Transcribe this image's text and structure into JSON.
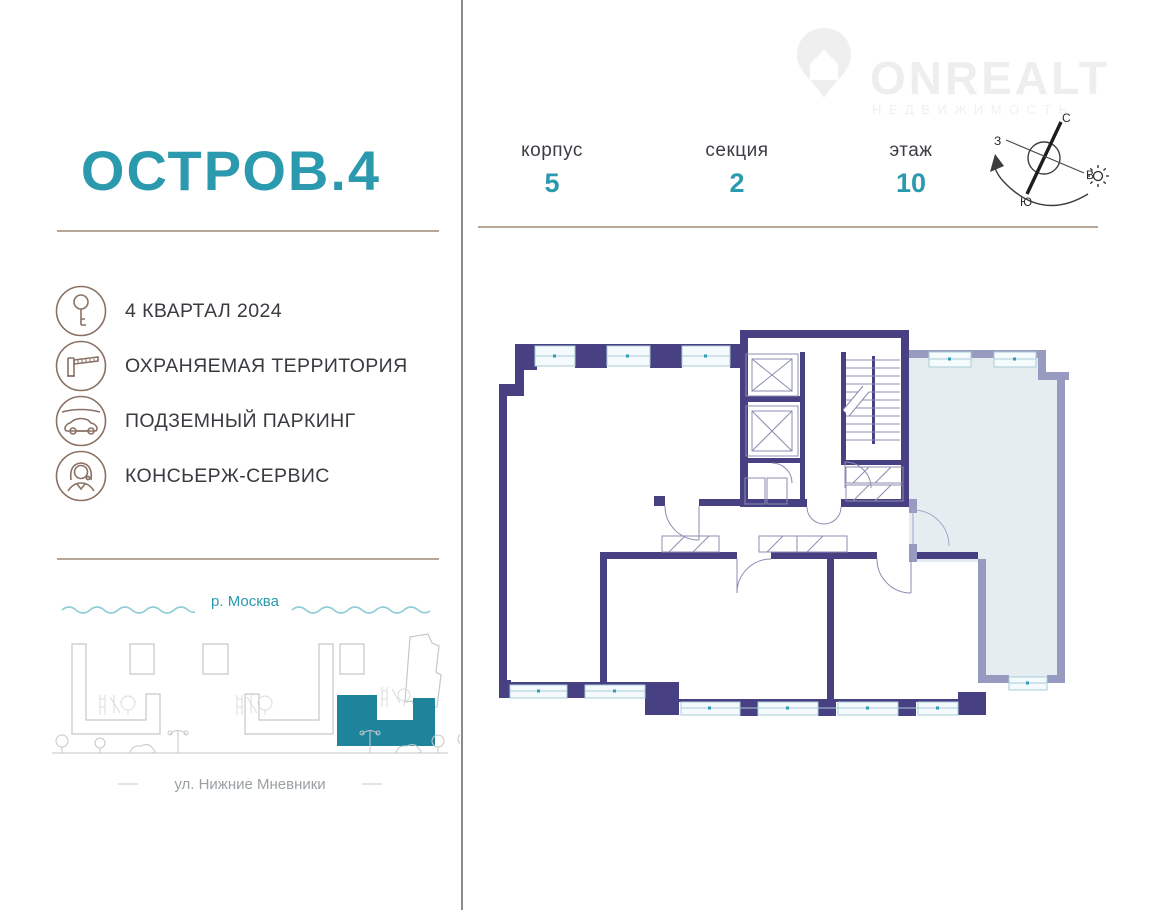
{
  "logo": {
    "text": "ONREALT",
    "subtext": "НЕДВИЖИМОСТЬ"
  },
  "project": {
    "title": "ОСТРОВ.4"
  },
  "unit": {
    "blocks": [
      {
        "label": "корпус",
        "value": "5"
      },
      {
        "label": "секция",
        "value": "2"
      },
      {
        "label": "этаж",
        "value": "10"
      }
    ]
  },
  "compass": {
    "n": "С",
    "s": "Ю",
    "w": "З",
    "e": "В"
  },
  "features": {
    "items": [
      {
        "icon": "key-icon",
        "label": "4 КВАРТАЛ 2024"
      },
      {
        "icon": "barrier-icon",
        "label": "ОХРАНЯЕМАЯ ТЕРРИТОРИЯ"
      },
      {
        "icon": "car-icon",
        "label": "ПОДЗЕМНЫЙ ПАРКИНГ"
      },
      {
        "icon": "concierge-icon",
        "label": "КОНСЬЕРЖ-СЕРВИС"
      }
    ]
  },
  "map": {
    "river": "р. Москва",
    "street": "ул. Нижние Мневники"
  },
  "colors": {
    "accent": "#2b9aae",
    "wall": "#474083",
    "wall_muted": "#989bc0",
    "apartment_muted_fill": "#e6edf0",
    "window_fill": "#f5fbfd",
    "icon_brown": "#8a7164",
    "divider": "#b6a99c",
    "map_highlight": "#1d849c"
  }
}
